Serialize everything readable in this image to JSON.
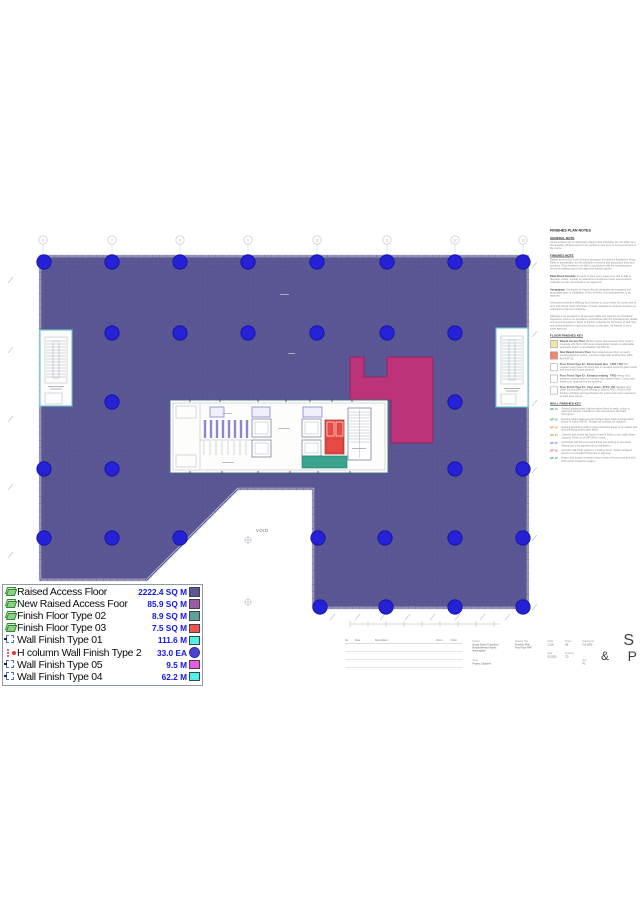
{
  "colors": {
    "floor": "#5b5795",
    "floor_new": "#bd3379",
    "column_dot": "#2421d6",
    "finish_type02": "#3aa38e",
    "finish_type03": "#e64a45",
    "stall_partition": "#8d87cd",
    "stair_outline": "#6cc4cc",
    "legend_value_text": "#1414e6"
  },
  "plan": {
    "void_label": "VOID",
    "grid_bubble_labels": [
      "6",
      "7",
      "8",
      "9",
      "10",
      "11",
      "12",
      "13"
    ],
    "grid_x": [
      43,
      112,
      180,
      248,
      317,
      387,
      455,
      523
    ],
    "column_dots": [
      [
        44,
        262
      ],
      [
        112,
        262
      ],
      [
        180,
        262
      ],
      [
        248,
        262
      ],
      [
        317,
        262
      ],
      [
        387,
        262
      ],
      [
        455,
        262
      ],
      [
        523,
        262
      ],
      [
        112,
        333
      ],
      [
        180,
        333
      ],
      [
        248,
        333
      ],
      [
        317,
        333
      ],
      [
        387,
        333
      ],
      [
        455,
        333
      ],
      [
        112,
        402
      ],
      [
        455,
        402
      ],
      [
        44,
        469
      ],
      [
        112,
        469
      ],
      [
        455,
        469
      ],
      [
        523,
        469
      ],
      [
        44,
        538
      ],
      [
        112,
        538
      ],
      [
        180,
        538
      ],
      [
        318,
        538
      ],
      [
        385,
        538
      ],
      [
        455,
        538
      ],
      [
        523,
        538
      ],
      [
        320,
        607
      ],
      [
        386,
        607
      ],
      [
        455,
        607
      ],
      [
        523,
        607
      ]
    ]
  },
  "legend": {
    "rows": [
      {
        "icon": "layer",
        "label": "Raised Access Floor",
        "value": "2222.4 SQ M",
        "color": "#5b5795",
        "shape": "square"
      },
      {
        "icon": "layer",
        "label": "New Raised Access Foor",
        "value": "85.9 SQ M",
        "color": "#9c59a6",
        "shape": "square"
      },
      {
        "icon": "layer",
        "label": "Finish Floor Type 02",
        "value": "8.9 SQ M",
        "color": "#5da295",
        "shape": "square"
      },
      {
        "icon": "layer",
        "label": "Finish Floor Type 03",
        "value": "7.5 SQ M",
        "color": "#f2554f",
        "shape": "square"
      },
      {
        "icon": "bracket",
        "label": "Wall Finish Type 01",
        "value": "111.6 M",
        "color": "#52efe8",
        "shape": "square"
      },
      {
        "icon": "dots",
        "label": "H column Wall Finish Type 2",
        "value": "33.0 EA",
        "color": "#4b43d6",
        "shape": "circle"
      },
      {
        "icon": "bracket",
        "label": "Wall Finish Type 05",
        "value": "9.5 M",
        "color": "#ef59e0",
        "shape": "square"
      },
      {
        "icon": "bracket",
        "label": "Wall Finish Type 04",
        "value": "62.2 M",
        "color": "#52efe8",
        "shape": "square"
      }
    ]
  },
  "notes": {
    "title": "FINISHES PLAN NOTES",
    "sections": [
      {
        "heading": "GENERAL NOTE",
        "lead": "",
        "body": "All dimensions are in millimetres unless noted otherwise. Do not scale from this drawing. All dimensions to be verified on site prior to commencement of the works."
      },
      {
        "heading": "FINISHES NOTE",
        "lead": "",
        "body": "Raised access floor zone includes allowance for services distribution below. Refer to specification for full schedule of finishes and associated trims and junctions. Floor finishes to be laid in accordance with the manufacturers recommendations and to the approved sample panels."
      },
      {
        "heading": "",
        "lead": "Plant Room Screeds:",
        "body": "Screeds to plant room areas to be laid to falls to drainage outlets. Include for waterproof membrane below screed where indicated on plan. All screeds to be approved."
      },
      {
        "heading": "",
        "lead": "Acceptance:",
        "body": "Contractor to ensure that all substrates are prepared and acceptable prior to installation of floor finishes. Any discrepancies to be reported."
      },
      {
        "heading": "",
        "lead": "",
        "body": "All junctions between differing floor finishes to occur under the centre line of door leaf unless noted otherwise. Provide matwells at entrance locations as indicated on plan and schedule."
      },
      {
        "heading": "",
        "lead": "",
        "body": "Skirtings to be provided to all perimeter walls and columns as scheduled. Expansion joints to be provided in accordance with the manufacturers details and recommendations. Refer to finishes schedule for full extent of wall, floor and ceiling finishes to each area shown on this plan. All finishes to be to client approval."
      }
    ],
    "floor_key": {
      "heading": "FLOOR FINISHES KEY",
      "items": [
        {
          "color": "#f3e3ac",
          "title": "Raised Access Floor",
          "text": "Medium grade raised access floor system complete with 600 x 600 steel encapsulated panels on adjustable pedestals. Refer to specification ref RAF-01."
        },
        {
          "color": "#f2886b",
          "title": "New Raised Access Floor",
          "text": "New raised access floor to match existing adjacent system. Levels to align with existing floor plate. Ref RAF-02."
        },
        {
          "color": "#ffffff",
          "title": "Floor Finish Type 02 - Resin based tiles - FF02 / T02",
          "text": "Slip resistant resin based tile finish laid on levelled screed to plant areas and risers with coved upstand."
        },
        {
          "color": "#ffffff",
          "title": "Floor Finish Type 03 - Entrance matting - FF03",
          "text": "Heavy duty entrance matting system recessed into matwell frame. Colour and finish to be approved by the architect."
        },
        {
          "color": "#ffffff",
          "title": "Floor Finish Type 04 - Vinyl sheet - FF04 / V01",
          "text": "Welded vinyl sheet flooring with coved skirting to 150mm AFFL. Refer to the finishes schedule and specification for extent and colour selections to each area shown."
        }
      ]
    },
    "wall_key": {
      "heading": "WALL FINISHES KEY",
      "items": [
        {
          "tag": "WF-01",
          "color": "#3fa08d",
          "text": "Painted plasterboard. Matt emulsion finish to walls, colour to approved sample. Include for mist coat and two full coats throughout."
        },
        {
          "tag": "WF-02",
          "color": "#3fa08d",
          "text": "Existing walls made good and redecorated. Matt emulsion finish, colour to match WF-01. Prepare all surfaces as required."
        },
        {
          "tag": "WF-03",
          "color": "#d98a3f",
          "text": "Existing blockwork walls to risers and plant areas to be sealed with dust inhibiting sealer paint finish."
        },
        {
          "tag": "WF-04",
          "color": "#b8a23f",
          "text": "Cleaned and sealed fair faced concrete finish to core walls where exposed. Refer to ref WF-04 for extent."
        },
        {
          "tag": "WF-05",
          "color": "#5f7fd0",
          "text": "Full height wall tiling on board lining and tanking to wet areas. Setting out to be agreed prior to installation."
        },
        {
          "tag": "WF-06",
          "color": "#c66a6a",
          "text": "Acoustic wall lining system to meeting rooms. Fabric wrapped panels on concealed fixing rails to approval."
        },
        {
          "tag": "WF-07",
          "color": "#3fa08d",
          "text": "Heavy duty impact resistant lining to back of house corridors with PVC corner protection angles."
        }
      ]
    }
  },
  "title_block": {
    "revision": {
      "headers": [
        "No.",
        "Date",
        "Description",
        "Drwn",
        "Chkd"
      ]
    },
    "groups": [
      {
        "label": "Project",
        "lines": [
          "Broad Street Chambers",
          "Refurbishment Works",
          "Birmingham"
        ]
      },
      {
        "label": "Client",
        "lines": [
          "Project Chapters"
        ]
      },
      {
        "label": "Drawing Title",
        "lines": [
          "Finishes Plan",
          "First Floor RAF"
        ]
      },
      {
        "label": "Scale",
        "lines": [
          "1:100"
        ]
      },
      {
        "label": "Drawn",
        "lines": [
          "AB"
        ]
      },
      {
        "label": "Date",
        "lines": [
          "03.2020"
        ]
      },
      {
        "label": "Checked",
        "lines": [
          "CD"
        ]
      },
      {
        "label": "Drawing No",
        "lines": [
          "GA 1603"
        ]
      },
      {
        "label": "Rev",
        "lines": [
          "P1"
        ]
      }
    ],
    "logo": {
      "s": "S",
      "amp": "&",
      "p": "P"
    }
  }
}
